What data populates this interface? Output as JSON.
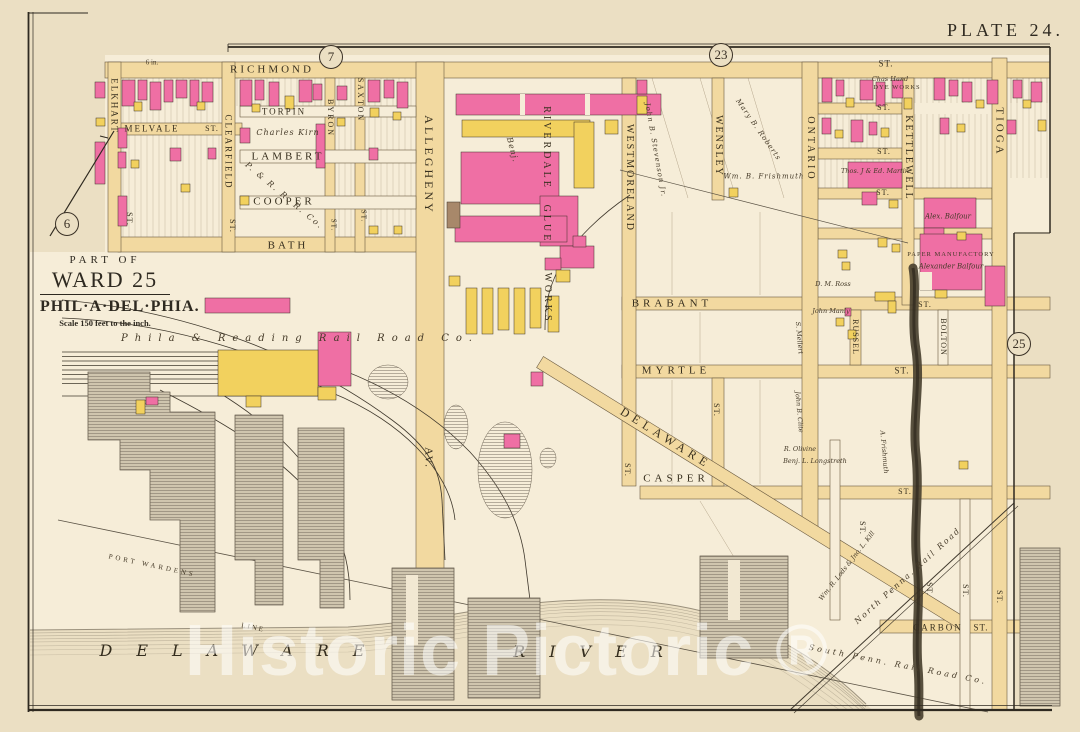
{
  "plate": {
    "title": "PLATE 24."
  },
  "title_block": {
    "part_of": "PART OF",
    "ward": "WARD 25",
    "city": "PHIL·A·DEL·PHIA.",
    "scale": "Scale 150 feet to the inch."
  },
  "watermark": "Historic Pictoric ®",
  "colors": {
    "paper": "#ebdfc3",
    "block": "#f6edd8",
    "street": "#f2d9a0",
    "building_pink": "#ef6fa4",
    "building_yellow": "#f2d15e",
    "building_brown": "#a8886a",
    "ink": "#3a3126",
    "water_line": "#847a68",
    "creek": "#473e2e",
    "watermark": "rgba(255,255,255,0.55)"
  },
  "map": {
    "refs": [
      {
        "t": "6",
        "x": 67,
        "y": 224
      },
      {
        "t": "7",
        "x": 331,
        "y": 57
      },
      {
        "t": "23",
        "x": 721,
        "y": 55
      },
      {
        "t": "25",
        "x": 1019,
        "y": 344
      }
    ],
    "labels": [
      {
        "t": "RICHMOND",
        "x": 272,
        "y": 70,
        "s": 11,
        "r": 0,
        "ls": 3,
        "c": "st",
        "n": "street-richmond"
      },
      {
        "t": "ST.",
        "x": 886,
        "y": 64,
        "s": 9,
        "r": 0,
        "ls": 1,
        "c": "st",
        "n": "street-st"
      },
      {
        "t": "MELVALE",
        "x": 152,
        "y": 129,
        "s": 9,
        "r": 0,
        "ls": 2,
        "c": "st",
        "n": "street-melvale"
      },
      {
        "t": "ST.",
        "x": 212,
        "y": 129,
        "s": 8,
        "r": 0,
        "ls": 1,
        "c": "st",
        "n": "street-st"
      },
      {
        "t": "TORPIN",
        "x": 284,
        "y": 112,
        "s": 9,
        "r": 0,
        "ls": 2,
        "c": "st",
        "n": "street-torpin"
      },
      {
        "t": "LAMBERT",
        "x": 288,
        "y": 157,
        "s": 11,
        "r": 0,
        "ls": 3,
        "c": "st",
        "n": "street-lambert"
      },
      {
        "t": "COOPER",
        "x": 284,
        "y": 202,
        "s": 11,
        "r": 0,
        "ls": 3,
        "c": "st",
        "n": "street-cooper"
      },
      {
        "t": "BATH",
        "x": 288,
        "y": 246,
        "s": 11,
        "r": 0,
        "ls": 3,
        "c": "st",
        "n": "street-bath"
      },
      {
        "t": "BRABANT",
        "x": 672,
        "y": 304,
        "s": 11,
        "r": 0,
        "ls": 4,
        "c": "st",
        "n": "street-brabant"
      },
      {
        "t": "MYRTLE",
        "x": 676,
        "y": 371,
        "s": 11,
        "r": 0,
        "ls": 4,
        "c": "st",
        "n": "street-myrtle"
      },
      {
        "t": "ST.",
        "x": 902,
        "y": 371,
        "s": 9,
        "r": 0,
        "ls": 1,
        "c": "st",
        "n": "street-st"
      },
      {
        "t": "CASPER",
        "x": 676,
        "y": 479,
        "s": 11,
        "r": 0,
        "ls": 4,
        "c": "st",
        "n": "street-casper"
      },
      {
        "t": "ST.",
        "x": 905,
        "y": 492,
        "s": 8,
        "r": 0,
        "ls": 1,
        "c": "st",
        "n": "street-st"
      },
      {
        "t": "CARBON",
        "x": 938,
        "y": 628,
        "s": 9,
        "r": 0,
        "ls": 2,
        "c": "st",
        "n": "street-carbon"
      },
      {
        "t": "ST.",
        "x": 981,
        "y": 628,
        "s": 9,
        "r": 0,
        "ls": 1,
        "c": "st",
        "n": "street-st"
      },
      {
        "t": "DELAWARE",
        "x": 666,
        "y": 438,
        "s": 12,
        "r": 32,
        "ls": 5,
        "c": "st",
        "n": "street-delaware-av"
      },
      {
        "t": "ST.",
        "x": 884,
        "y": 108,
        "s": 8,
        "r": 0,
        "ls": 1,
        "c": "st",
        "n": "street-st"
      },
      {
        "t": "ST.",
        "x": 884,
        "y": 152,
        "s": 8,
        "r": 0,
        "ls": 1,
        "c": "st",
        "n": "street-st"
      },
      {
        "t": "ST.",
        "x": 883,
        "y": 193,
        "s": 8,
        "r": 0,
        "ls": 1,
        "c": "st",
        "n": "street-st"
      },
      {
        "t": "ST.",
        "x": 925,
        "y": 305,
        "s": 8,
        "r": 0,
        "ls": 1,
        "c": "st",
        "n": "street-st"
      },
      {
        "t": "6 in.",
        "x": 152,
        "y": 63,
        "s": 7,
        "r": 0,
        "ls": 0,
        "c": "fine",
        "n": "survey-note"
      },
      {
        "t": "ELKHART",
        "x": 114,
        "y": 106,
        "s": 9,
        "r": 90,
        "ls": 2,
        "c": "st",
        "n": "street-elkhart"
      },
      {
        "t": "ST.",
        "x": 129,
        "y": 219,
        "s": 8,
        "r": 90,
        "ls": 1,
        "c": "st",
        "n": "street-st"
      },
      {
        "t": "CLEARFIELD",
        "x": 228,
        "y": 152,
        "s": 9,
        "r": 90,
        "ls": 2,
        "c": "st",
        "n": "street-clearfield"
      },
      {
        "t": "ST.",
        "x": 232,
        "y": 226,
        "s": 8,
        "r": 90,
        "ls": 1,
        "c": "st",
        "n": "street-st"
      },
      {
        "t": "BYRON",
        "x": 330,
        "y": 118,
        "s": 8,
        "r": 90,
        "ls": 2,
        "c": "st",
        "n": "street-byron"
      },
      {
        "t": "ST.",
        "x": 333,
        "y": 225,
        "s": 7,
        "r": 90,
        "ls": 1,
        "c": "st",
        "n": "street-st"
      },
      {
        "t": "SAXTON",
        "x": 360,
        "y": 100,
        "s": 8,
        "r": 90,
        "ls": 2,
        "c": "st",
        "n": "street-saxton"
      },
      {
        "t": "ST.",
        "x": 363,
        "y": 216,
        "s": 7,
        "r": 90,
        "ls": 1,
        "c": "st",
        "n": "street-st"
      },
      {
        "t": "ALLEGHENY",
        "x": 429,
        "y": 165,
        "s": 12,
        "r": 90,
        "ls": 3,
        "c": "st",
        "n": "street-allegheny"
      },
      {
        "t": "AV.",
        "x": 428,
        "y": 458,
        "s": 11,
        "r": 90,
        "ls": 2,
        "c": "st",
        "n": "street-allegheny-av"
      },
      {
        "t": "RIVERDALE",
        "x": 546,
        "y": 148,
        "s": 10,
        "r": 90,
        "ls": 3,
        "c": "st",
        "n": "riverdale-glue-works-label"
      },
      {
        "t": "GLUE",
        "x": 546,
        "y": 224,
        "s": 10,
        "r": 90,
        "ls": 3,
        "c": "st",
        "n": "riverdale-glue-works-label"
      },
      {
        "t": "WORKS",
        "x": 547,
        "y": 298,
        "s": 10,
        "r": 90,
        "ls": 3,
        "c": "st",
        "n": "riverdale-glue-works-label"
      },
      {
        "t": "WESTMORELAND",
        "x": 629,
        "y": 178,
        "s": 10,
        "r": 90,
        "ls": 2,
        "c": "st",
        "n": "street-westmoreland"
      },
      {
        "t": "WENSLEY",
        "x": 718,
        "y": 146,
        "s": 10,
        "r": 90,
        "ls": 2,
        "c": "st",
        "n": "street-wensley"
      },
      {
        "t": "ONTARIO",
        "x": 810,
        "y": 149,
        "s": 10,
        "r": 90,
        "ls": 3,
        "c": "st",
        "n": "street-ontario"
      },
      {
        "t": "KETTLEWELL",
        "x": 908,
        "y": 158,
        "s": 10,
        "r": 90,
        "ls": 2,
        "c": "st",
        "n": "street-kettlewell"
      },
      {
        "t": "TIOGA",
        "x": 999,
        "y": 132,
        "s": 11,
        "r": 90,
        "ls": 3,
        "c": "st",
        "n": "street-tioga"
      },
      {
        "t": "RUSSEL",
        "x": 855,
        "y": 337,
        "s": 8,
        "r": 90,
        "ls": 1,
        "c": "st",
        "n": "street-russel"
      },
      {
        "t": "BOLTON",
        "x": 943,
        "y": 337,
        "s": 8,
        "r": 90,
        "ls": 1,
        "c": "st",
        "n": "street-bolton"
      },
      {
        "t": "ST.",
        "x": 627,
        "y": 470,
        "s": 8,
        "r": 90,
        "ls": 1,
        "c": "st",
        "n": "street-st"
      },
      {
        "t": "ST.",
        "x": 716,
        "y": 410,
        "s": 8,
        "r": 90,
        "ls": 1,
        "c": "st",
        "n": "street-st"
      },
      {
        "t": "ST.",
        "x": 862,
        "y": 528,
        "s": 8,
        "r": 90,
        "ls": 1,
        "c": "st",
        "n": "street-st"
      },
      {
        "t": "ST.",
        "x": 929,
        "y": 589,
        "s": 8,
        "r": 90,
        "ls": 1,
        "c": "st",
        "n": "street-st"
      },
      {
        "t": "ST.",
        "x": 965,
        "y": 591,
        "s": 8,
        "r": 90,
        "ls": 1,
        "c": "st",
        "n": "street-st"
      },
      {
        "t": "ST.",
        "x": 999,
        "y": 597,
        "s": 8,
        "r": 90,
        "ls": 1,
        "c": "st",
        "n": "street-st"
      },
      {
        "t": "Charles Kirn",
        "x": 288,
        "y": 133,
        "s": 8,
        "r": 0,
        "ls": 1,
        "c": "it",
        "n": "owner-charles-kirn"
      },
      {
        "t": "P. & R. R. R. Co.",
        "x": 284,
        "y": 196,
        "s": 8,
        "r": 40,
        "ls": 2,
        "c": "it",
        "n": "owner-prrr-co"
      },
      {
        "t": "Phila & Reading Rail Road Co.",
        "x": 300,
        "y": 339,
        "s": 10,
        "r": 0,
        "ls": 7,
        "c": "it",
        "n": "phila-reading-railroad-label"
      },
      {
        "t": "Benj.",
        "x": 512,
        "y": 150,
        "s": 8,
        "r": 75,
        "ls": 1,
        "c": "it",
        "n": "owner-benj"
      },
      {
        "t": "John B. Stevenson Jr.",
        "x": 655,
        "y": 150,
        "s": 7,
        "r": 80,
        "ls": 1,
        "c": "it",
        "n": "owner-john-b-stevenson"
      },
      {
        "t": "Mary B. Roberts",
        "x": 758,
        "y": 130,
        "s": 7,
        "r": 55,
        "ls": 1,
        "c": "it",
        "n": "owner-mary-b-roberts"
      },
      {
        "t": "Wm. B. Frishmuth",
        "x": 764,
        "y": 177,
        "s": 7,
        "r": 0,
        "ls": 1,
        "c": "it",
        "n": "owner-wm-b-frishmuth"
      },
      {
        "t": "Chas Hand",
        "x": 890,
        "y": 79,
        "s": 6.5,
        "r": 0,
        "ls": 0,
        "c": "it",
        "n": "owner-chas-hand"
      },
      {
        "t": "DYE WORKS",
        "x": 897,
        "y": 88,
        "s": 6.5,
        "r": 0,
        "ls": 1,
        "c": "fine",
        "n": "dye-works-label"
      },
      {
        "t": "Thos. J & Ed. Martin",
        "x": 875,
        "y": 171,
        "s": 6.5,
        "r": 0,
        "ls": 0,
        "c": "it",
        "n": "owner-thos-ed-martin"
      },
      {
        "t": "Alex. Balfour",
        "x": 948,
        "y": 217,
        "s": 7,
        "r": 0,
        "ls": 0,
        "c": "it",
        "n": "owner-alex-balfour"
      },
      {
        "t": "PAPER MANUFACTORY",
        "x": 951,
        "y": 255,
        "s": 6.5,
        "r": 0,
        "ls": 1,
        "c": "fine",
        "n": "paper-manufactory-label"
      },
      {
        "t": "Alexander Balfour",
        "x": 951,
        "y": 267,
        "s": 7,
        "r": 0,
        "ls": 0,
        "c": "it",
        "n": "owner-alexander-balfour"
      },
      {
        "t": "D. M. Ross",
        "x": 833,
        "y": 284,
        "s": 6.5,
        "r": 0,
        "ls": 0,
        "c": "it",
        "n": "owner-d-m-ross"
      },
      {
        "t": "John Manly",
        "x": 831,
        "y": 311,
        "s": 6.5,
        "r": 0,
        "ls": 0,
        "c": "it",
        "n": "owner-john-manly"
      },
      {
        "t": "S. Mellert",
        "x": 799,
        "y": 338,
        "s": 6.5,
        "r": 85,
        "ls": 0,
        "c": "it",
        "n": "owner-s-mellert"
      },
      {
        "t": "John B. Clite",
        "x": 799,
        "y": 412,
        "s": 6.5,
        "r": 85,
        "ls": 0,
        "c": "it",
        "n": "owner-john-b-clite"
      },
      {
        "t": "R. Olivine",
        "x": 800,
        "y": 449,
        "s": 6.5,
        "r": 0,
        "ls": 0,
        "c": "it",
        "n": "owner-r-olivine"
      },
      {
        "t": "Benj. L. Longstreth",
        "x": 815,
        "y": 461,
        "s": 6.5,
        "r": 0,
        "ls": 0,
        "c": "it",
        "n": "owner-benj-longstreth"
      },
      {
        "t": "A. Frishmuth",
        "x": 884,
        "y": 452,
        "s": 6.5,
        "r": 85,
        "ls": 0,
        "c": "it",
        "n": "owner-a-frishmuth"
      },
      {
        "t": "Wm. R. Lods & Jno. L. Kill",
        "x": 847,
        "y": 566,
        "s": 6.5,
        "r": -52,
        "ls": 0,
        "c": "it",
        "n": "owner-lods-kill"
      },
      {
        "t": "North Penna. Rail Road",
        "x": 908,
        "y": 576,
        "s": 8,
        "r": -42,
        "ls": 2,
        "c": "it",
        "n": "north-penna-railroad-label"
      },
      {
        "t": "South Penn. Rail Road Co.",
        "x": 898,
        "y": 665,
        "s": 8,
        "r": 11,
        "ls": 3,
        "c": "it",
        "n": "south-penn-railroad-label"
      },
      {
        "t": "PORT WARDENS",
        "x": 152,
        "y": 566,
        "s": 7,
        "r": 12,
        "ls": 3,
        "c": "fine",
        "n": "port-wardens-line-label"
      },
      {
        "t": "LINE",
        "x": 253,
        "y": 628,
        "s": 7,
        "r": 12,
        "ls": 2,
        "c": "fine",
        "n": "port-wardens-line-label"
      },
      {
        "t": "DELAWARE",
        "x": 244,
        "y": 651,
        "s": 16,
        "r": 0,
        "ls": 24,
        "c": "river",
        "n": "delaware-river-label"
      },
      {
        "t": "RIVER",
        "x": 600,
        "y": 652,
        "s": 16,
        "r": 0,
        "ls": 24,
        "c": "river",
        "n": "delaware-river-label"
      }
    ]
  }
}
